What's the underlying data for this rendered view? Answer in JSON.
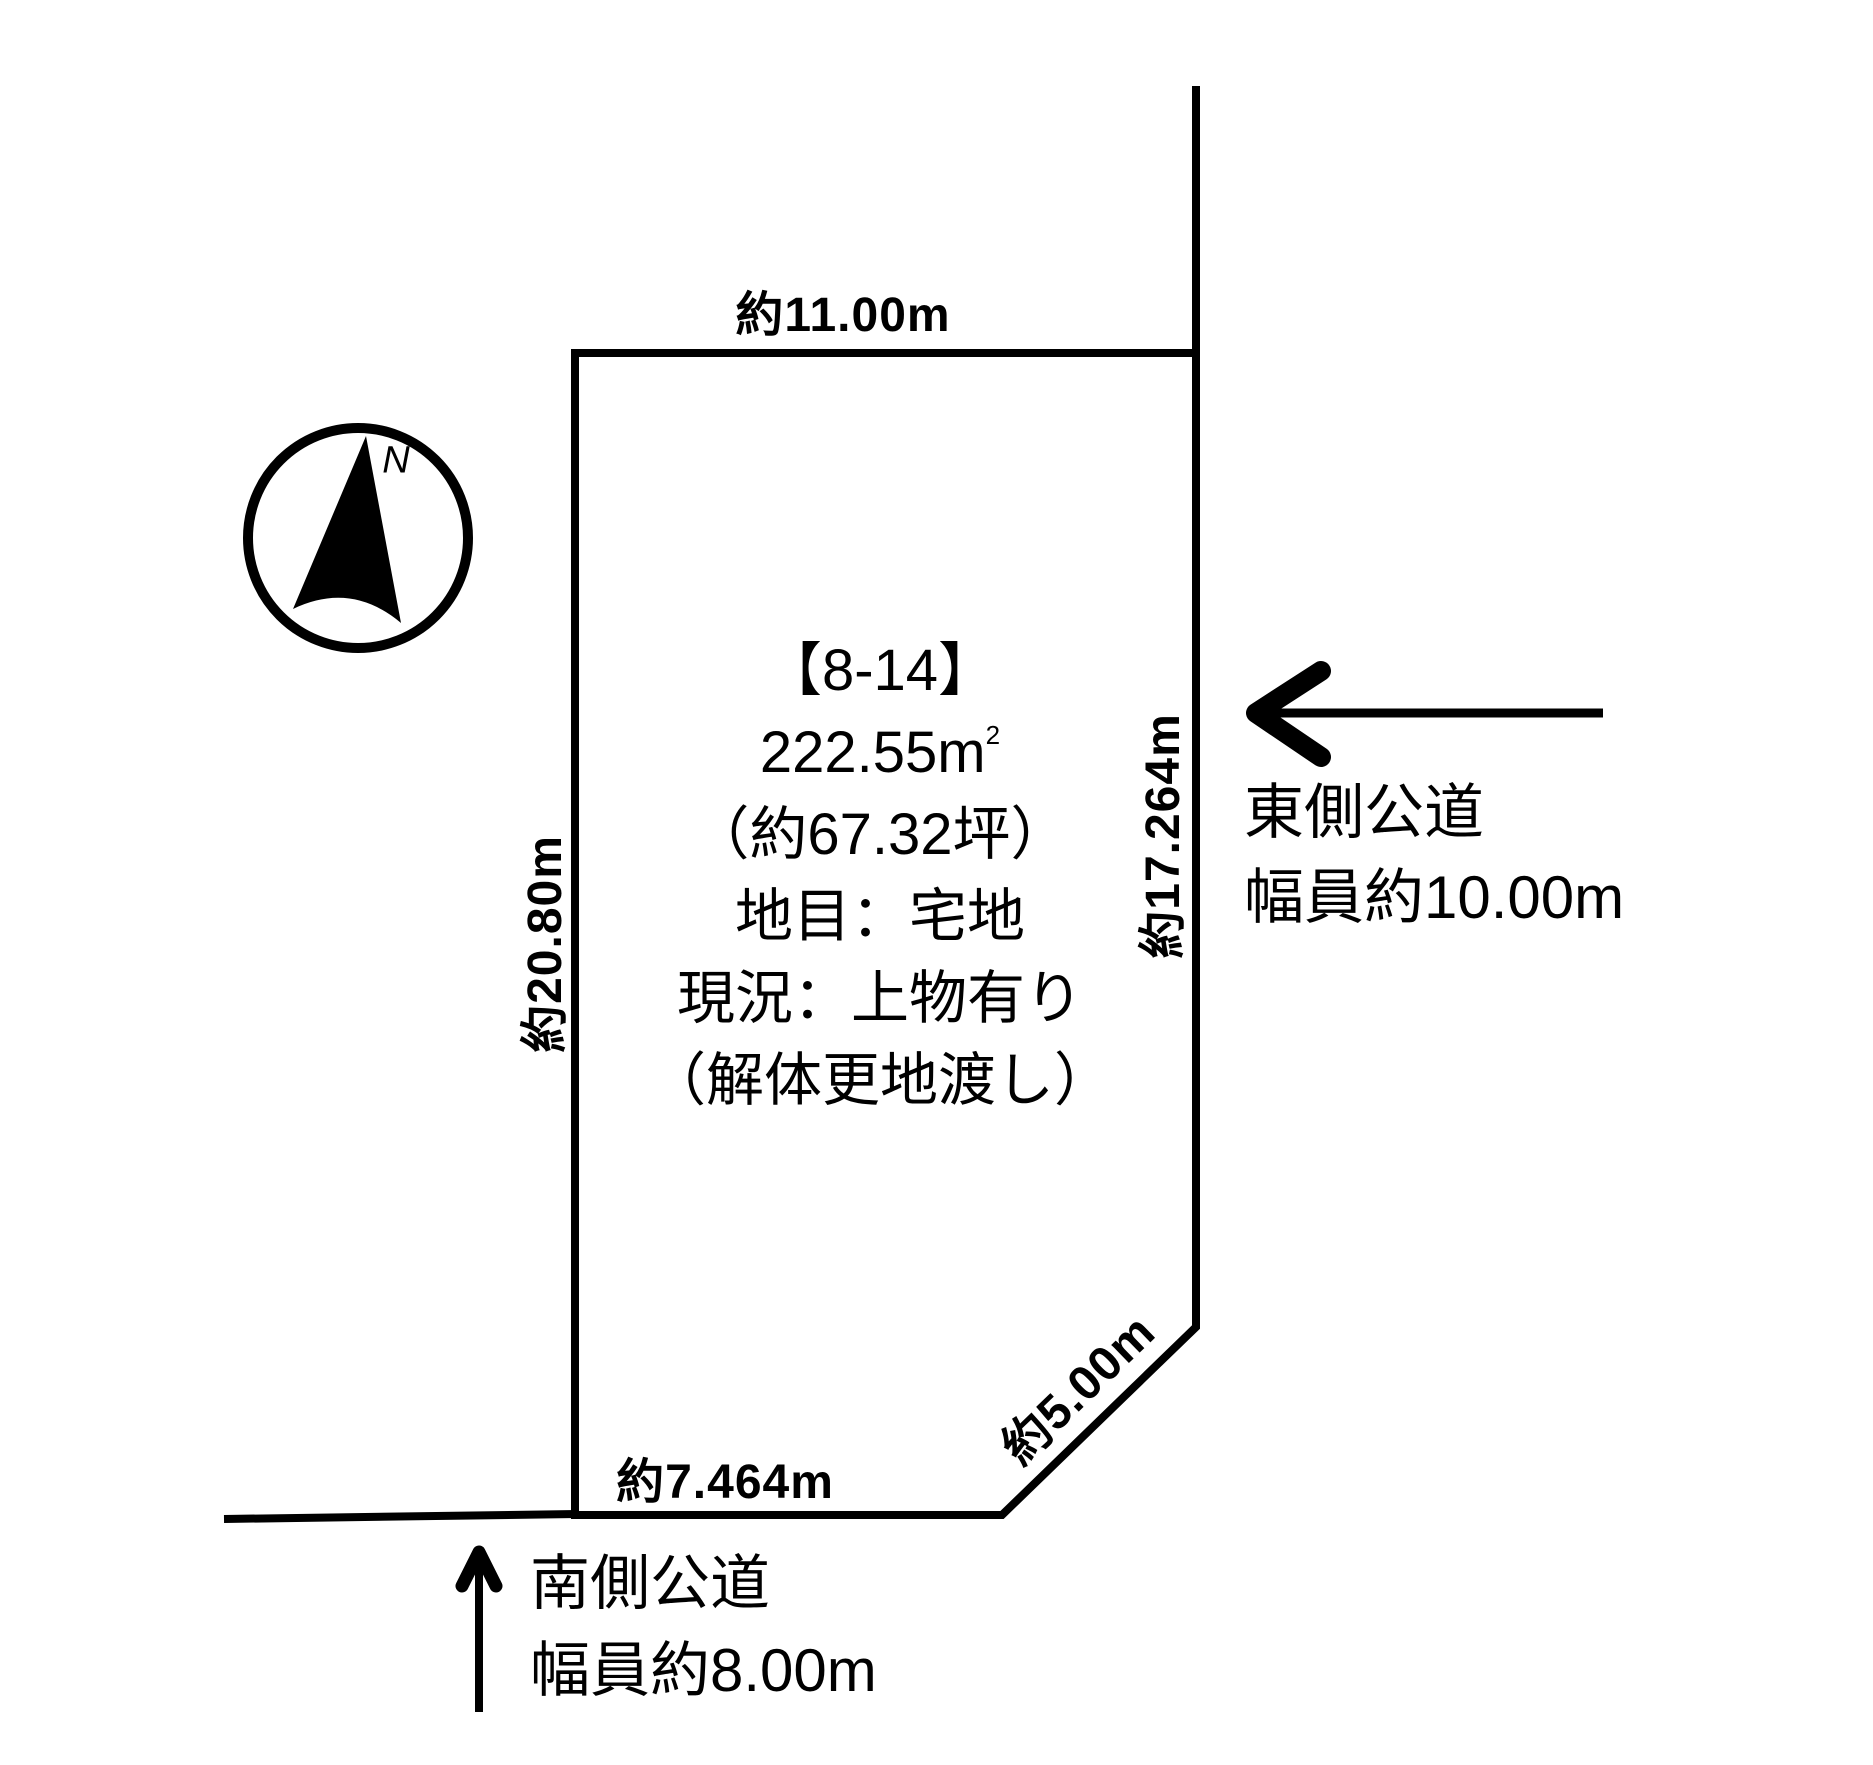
{
  "page": {
    "background": "#ffffff",
    "line_color": "#000000"
  },
  "compass": {
    "label": "N"
  },
  "parcel": {
    "id_label": "【8-14】",
    "area_value": "222.55m",
    "area_exponent": "2",
    "area_tsubo": "（約67.32坪）",
    "land_category": "地目：宅地",
    "current_status": "現況：上物有り",
    "delivery_condition": "（解体更地渡し）"
  },
  "dimensions": {
    "north_edge": "約11.00m",
    "west_edge": "約20.80m",
    "east_edge": "約17.264m",
    "south_edge": "約7.464m",
    "corner_edge": "約5.00m"
  },
  "roads": {
    "east": {
      "name": "東側公道",
      "width": "幅員約10.00m"
    },
    "south": {
      "name": "南側公道",
      "width": "幅員約8.00m"
    }
  }
}
